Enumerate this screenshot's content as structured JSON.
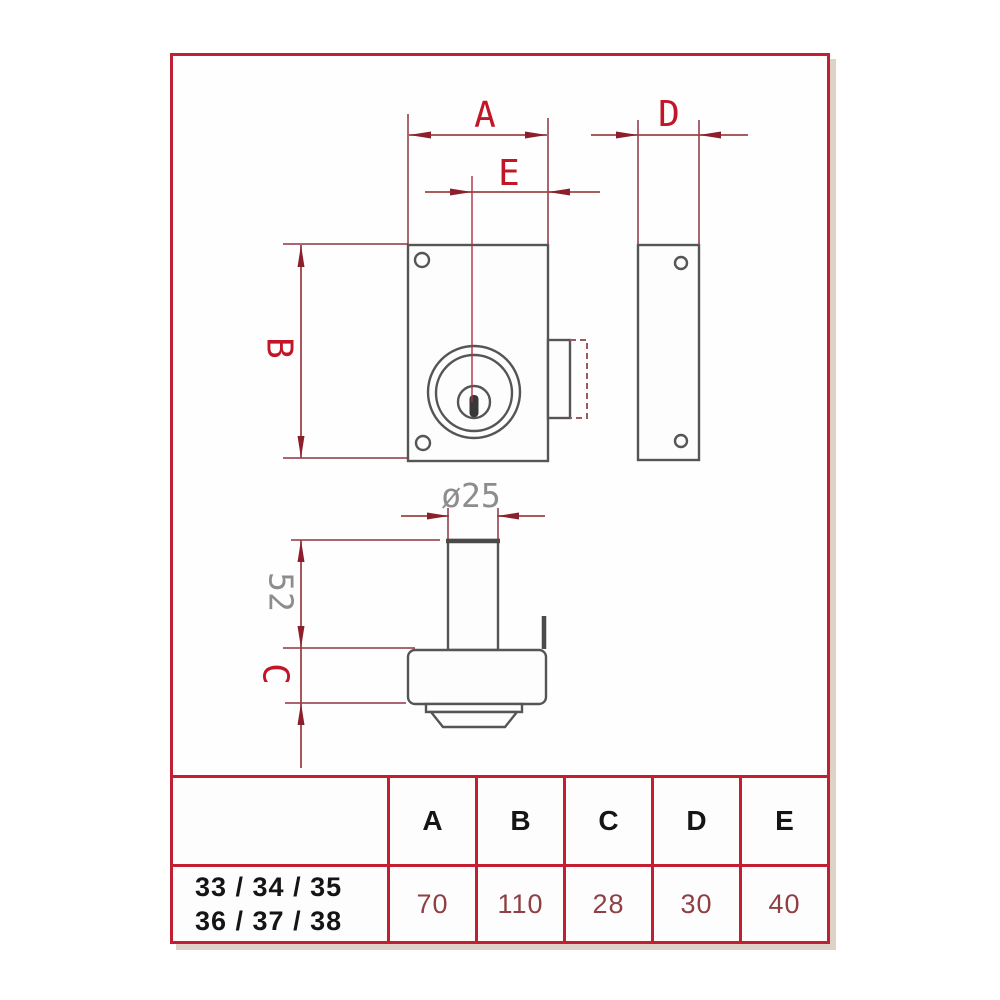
{
  "drawing": {
    "labels": {
      "a": "A",
      "b": "B",
      "c": "C",
      "d": "D",
      "e": "E",
      "cylinder_length": "52",
      "cylinder_diameter": "ø25"
    },
    "colors": {
      "outline_gray": "#555555",
      "dimension_line": "#9d4444",
      "extension_line": "#8f3340",
      "label_red": "#c21527",
      "label_gray": "#8d8d8d",
      "centerline_red": "#b03043"
    }
  },
  "table": {
    "headers": [
      "A",
      "B",
      "C",
      "D",
      "E"
    ],
    "model_label": {
      "line1": "33 / 34 / 35",
      "line2": "36 / 37 / 38"
    },
    "values": [
      "70",
      "110",
      "28",
      "30",
      "40"
    ],
    "border_color": "#c41e33",
    "header_text_color": "#151515",
    "value_text_color": "#8e4045"
  },
  "frame": {
    "border_color": "#bf2034",
    "shadow_color": "#dcd2c6"
  }
}
